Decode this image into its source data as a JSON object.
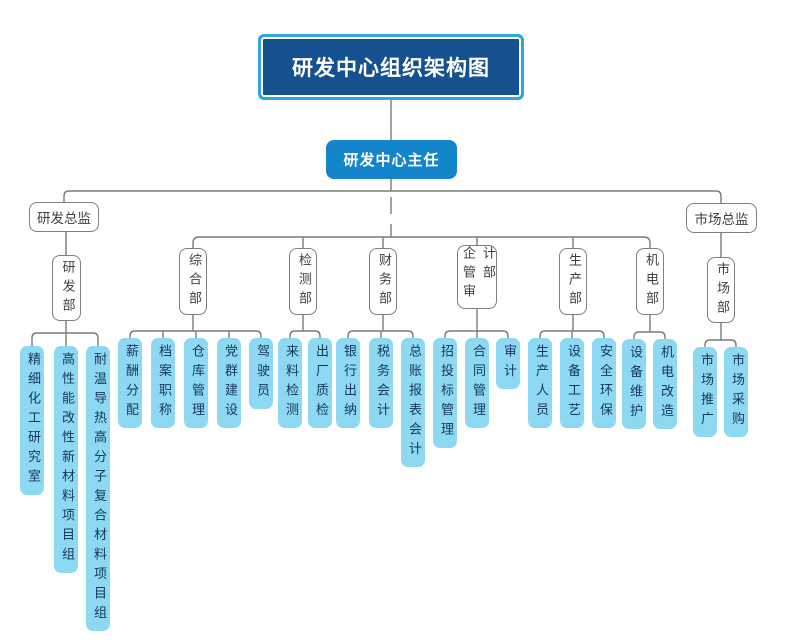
{
  "chart": {
    "title": "研发中心组织架构图",
    "director": "研发中心主任",
    "supervisor_left": "研发总监",
    "supervisor_right": "市场总监",
    "departments": [
      {
        "name": "研发部",
        "children": [
          "精细化工研究室",
          "高性能改性新材料项目组",
          "耐温导热高分子复合材料项目组"
        ]
      },
      {
        "name": "综合部",
        "children": [
          "薪酬分配",
          "档案职称",
          "仓库管理",
          "党群建设",
          "驾驶员"
        ]
      },
      {
        "name": "检测部",
        "children": [
          "来料检测",
          "出厂质检"
        ]
      },
      {
        "name": "财务部",
        "children": [
          "银行出纳",
          "税务会计",
          "总账报表会计"
        ]
      },
      {
        "name": "企管审计部",
        "children": [
          "招投标管理",
          "合同管理",
          "审计"
        ]
      },
      {
        "name": "生产部",
        "children": [
          "生产人员",
          "设备工艺",
          "安全环保"
        ]
      },
      {
        "name": "机电部",
        "children": [
          "设备维护",
          "机电改造"
        ]
      },
      {
        "name": "市场部",
        "children": [
          "市场推广",
          "市场采购"
        ]
      }
    ],
    "colors": {
      "title_fill": "#15508F",
      "title_border": "#2AA9E0",
      "director_fill": "#1585CB",
      "leaf_fill": "#8DD9F1",
      "leaf_text": "#17365D",
      "line": "#7A7A7A",
      "node_border": "#7F7F7F"
    }
  }
}
